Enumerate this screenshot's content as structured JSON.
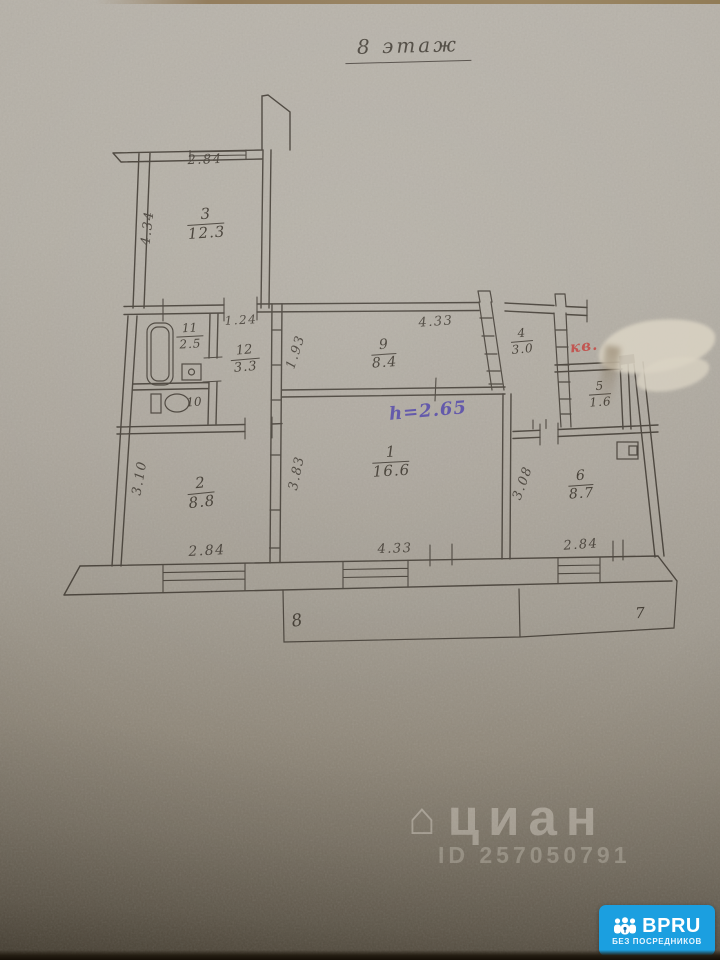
{
  "title": "8 этаж",
  "rooms": [
    {
      "num": "3",
      "area": "12.3"
    },
    {
      "num": "11",
      "area": "2.5"
    },
    {
      "num": "12",
      "area": "3.3"
    },
    {
      "num": "9",
      "area": "8.4"
    },
    {
      "num": "4",
      "area": "3.0"
    },
    {
      "num": "5",
      "area": "1.6"
    },
    {
      "num": "1",
      "area": "16.6"
    },
    {
      "num": "2",
      "area": "8.8"
    },
    {
      "num": "6",
      "area": "8.7"
    }
  ],
  "plain_labels": {
    "toilet": "10",
    "balcony_left": "8",
    "balcony_right": "7"
  },
  "dims": [
    {
      "text": "2.84"
    },
    {
      "text": "4.34"
    },
    {
      "text": "1.24"
    },
    {
      "text": "1.93"
    },
    {
      "text": "4.33"
    },
    {
      "text": "3.83"
    },
    {
      "text": "3.10"
    },
    {
      "text": "3.08"
    },
    {
      "text": "2.84"
    },
    {
      "text": "4.33"
    },
    {
      "text": "2.84"
    }
  ],
  "notes": {
    "height_note": "h=2.65",
    "red_note": "кв."
  },
  "watermark": {
    "house_glyph": "⌂",
    "brand": "циан",
    "id_text": "ID 257050791"
  },
  "badge": {
    "brand": "BPRU",
    "tagline": "БЕЗ ПОСРЕДНИКОВ"
  },
  "colors": {
    "ink": "#4a443c",
    "purple_ink": "#5b50a6",
    "red_ink": "#bf4f4a",
    "badge_blue": "#1b9fe0",
    "paper_light": "#b7b2a9",
    "paper_dark": "#4b4335"
  }
}
